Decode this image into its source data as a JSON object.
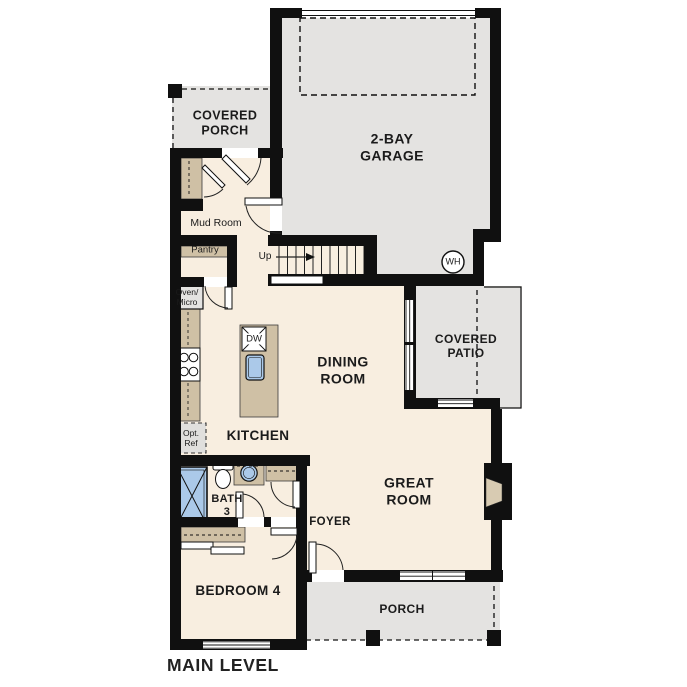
{
  "plan": {
    "level_title": "MAIN LEVEL",
    "type": "single-family home floor plan"
  },
  "labels": {
    "covered_porch": "COVERED\nPORCH",
    "garage": "2-BAY\nGARAGE",
    "mud_room": "Mud Room",
    "pantry": "Pantry",
    "up": "Up",
    "wh": "WH",
    "oven_micro": "Oven/\nMicro",
    "dining_room": "DINING\nROOM",
    "covered_patio": "COVERED\nPATIO",
    "dw": "DW",
    "opt_ref": "Opt.\nRef",
    "kitchen": "KITCHEN",
    "bath_3": "BATH\n3",
    "great_room": "GREAT\nROOM",
    "foyer": "FOYER",
    "bedroom_4": "BEDROOM 4",
    "porch": "PORCH",
    "main_level": "MAIN LEVEL"
  },
  "colors": {
    "wall": "#101010",
    "interior": "#f8eee0",
    "exterior": "#e4e3e1",
    "counter": "#cfc0a5",
    "water": "#abc9e9",
    "hearth": "#d8cbb2",
    "text": "#1b1b1b"
  }
}
